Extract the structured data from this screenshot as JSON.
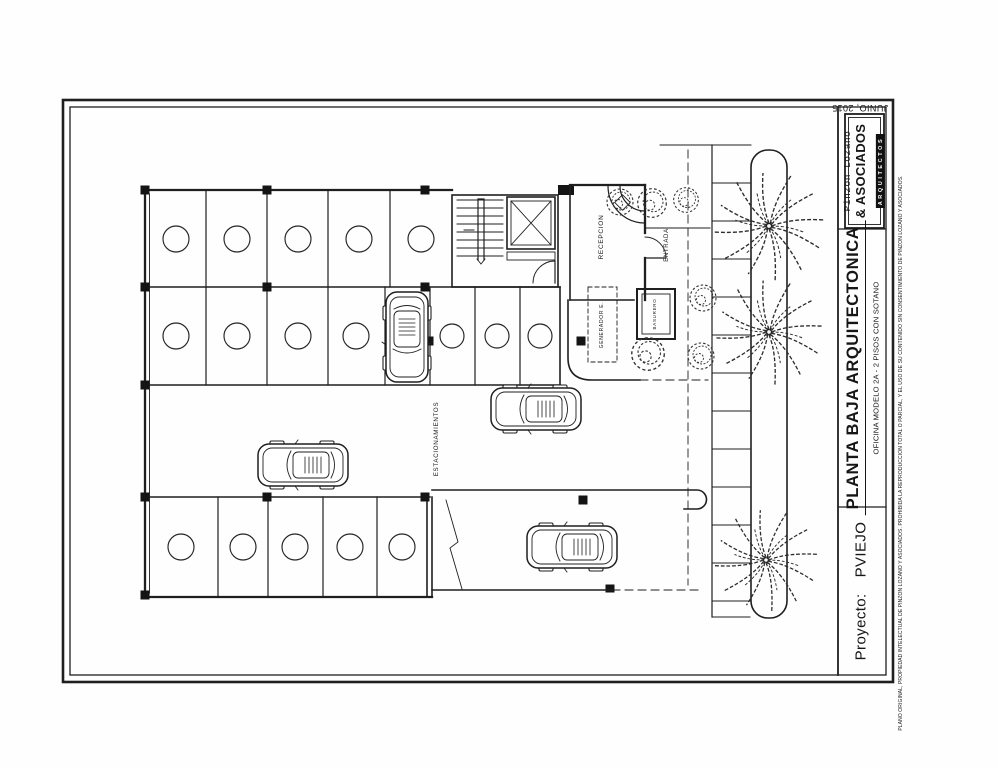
{
  "sheet": {
    "date": "JUNIO, 2015",
    "firm": {
      "name_line1": "Pinzon Lozano",
      "name_line2": "& ASOCIADOS",
      "name_line3": "ARQUITECTOS"
    },
    "title_block": {
      "drawing_title": "PLANTA BAJA ARQUITECTONICA",
      "drawing_subtitle": "OFICINA MODELO 2A - 2 PISOS CON SOTANO",
      "project_label": "Proyecto:",
      "project_name": "PVIEJO",
      "copyright_notice": "PLANO ORIGINAL, PROPIEDAD INTELECTUAL DE PINZON LOZANO Y ASOCIADOS. PROHIBIDA LA REPRODUCCION TOTAL O PARCIAL, Y EL USO DE SU CONTENIDO SIN CONSENTIMIENTO DE PINZON LOZANO Y ASOCIADOS."
    }
  },
  "plan": {
    "labels": {
      "reception": "RECEPCION",
      "entrance": "ENTRADA",
      "parking": "ESTACIONAMIENTOS",
      "generator": "GENERADOR E.",
      "trash_room": "BASURERO"
    },
    "counts": {
      "parking_stalls_top_row": 5,
      "parking_stalls_middle_row": 8,
      "parking_stalls_bottom_row": 5,
      "cars": 4,
      "palm_trees": 3,
      "shrubs": 6
    }
  }
}
